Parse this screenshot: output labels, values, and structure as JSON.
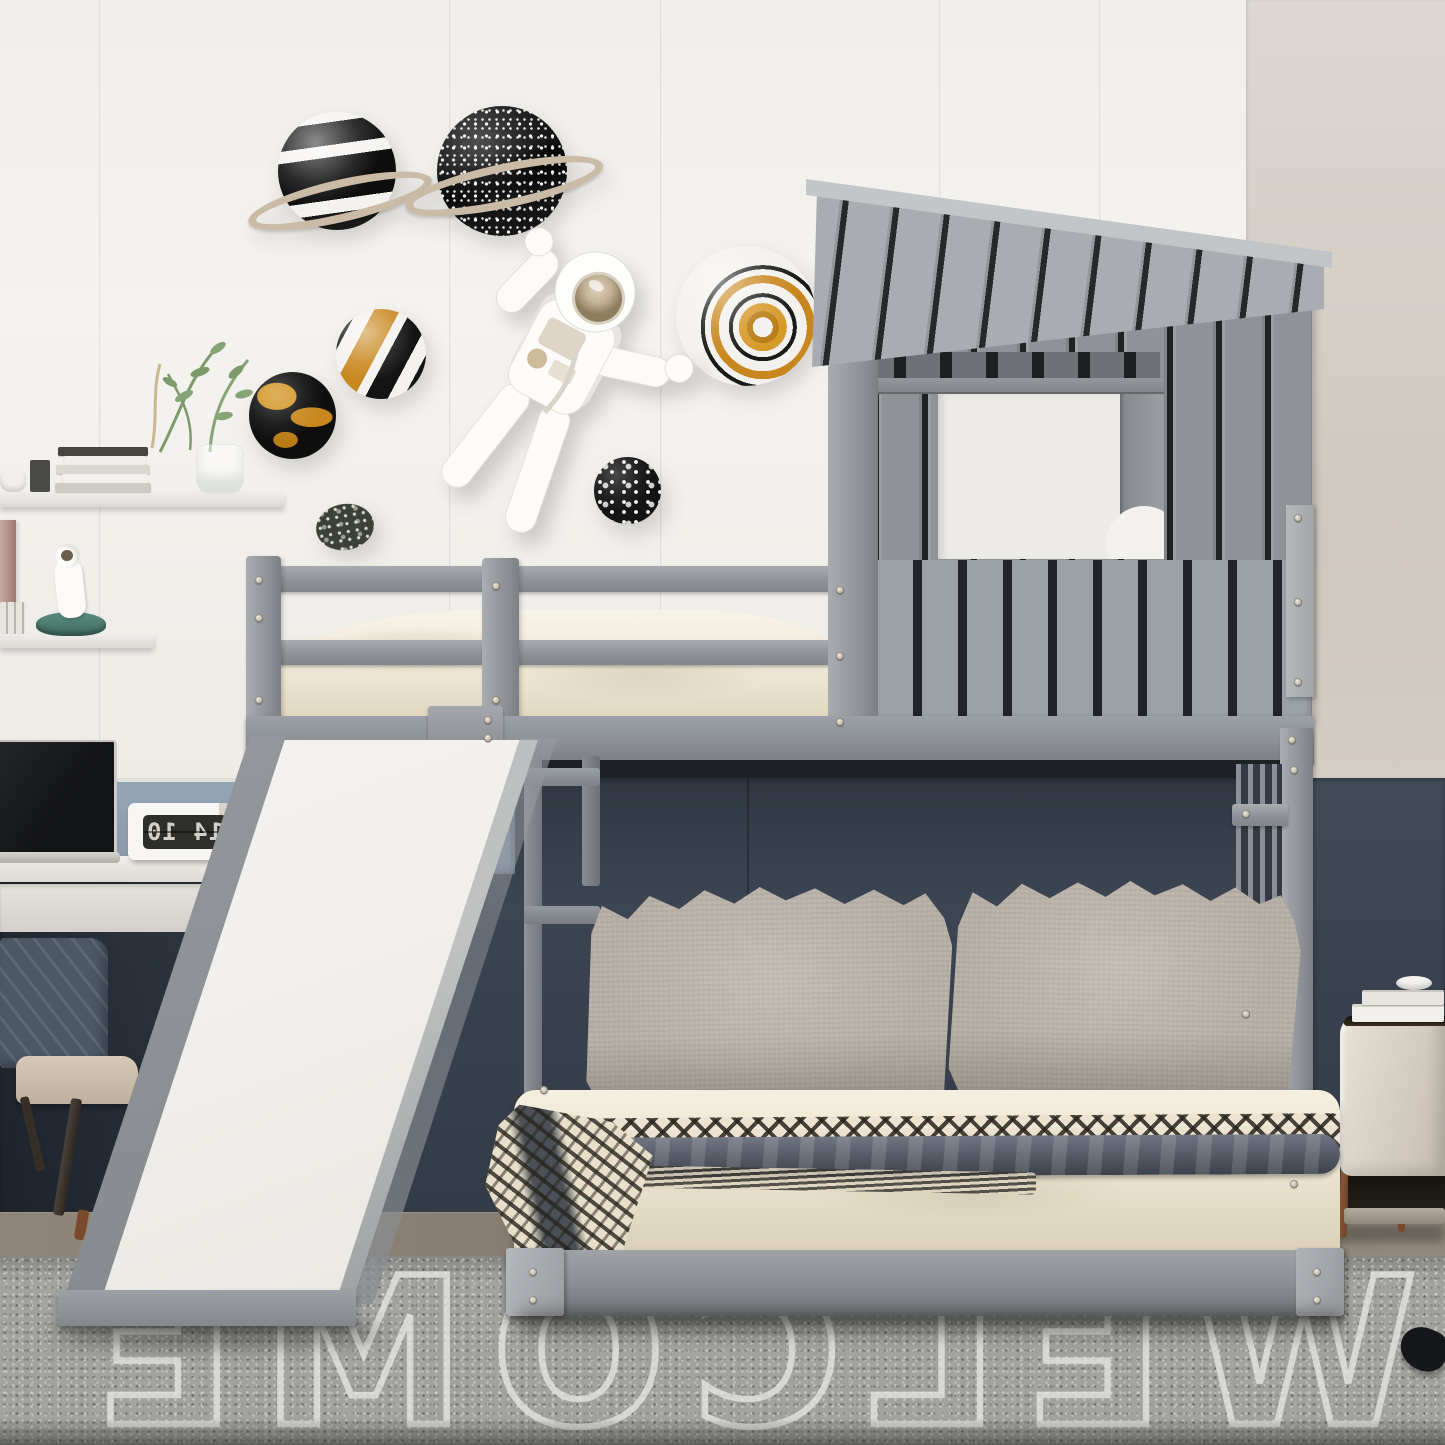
{
  "meta": {
    "title": "Kids bedroom with gray house-shaped loft bunk bed with slide over full-size platform bed",
    "style": "photorealistic interior render"
  },
  "colors": {
    "wallWhite": "#f2f0ed",
    "wallGreige": "#d6d0c9",
    "wainscot": "#3b4450",
    "wainscotDark": "#272e38",
    "panelBlue": "#8d9fb1",
    "wood": "#8b8177",
    "carpet": "#a2a29e",
    "carpetLine": "#e7e7e2",
    "carpetDarkBand": "#74736e",
    "bedGray": "#969a9e",
    "bedGrayLight": "#b2b5b8",
    "bedGrayDark": "#7c8084",
    "slatGap": "#24272a",
    "mattressCream": "#f2ecdc",
    "beddingCream": "#eae2cf",
    "pillowGray": "#b7b0a7",
    "throwGray": "#565c67",
    "blanketInk": "#2e2c27",
    "slideWhite": "#f6f4f1",
    "furnWhite": "#e9e6e2",
    "nightstand": "#d9d3c9",
    "nightstandTop": "#30261d",
    "copper": "#8a5637",
    "chairBack": "#4c5866",
    "chairSeat": "#c9bdaa",
    "legWood": "#3a332c",
    "screenDark": "#1a1b1d",
    "silver": "#c9c6c2",
    "clockBody": "#f6f4f0",
    "clockFace": "#2e2e2b",
    "clockDigits": "#d2d0c9",
    "gold": "#c8871e",
    "ringTan": "#c9bba6",
    "planetInk": "#141414",
    "planetWhite": "#f5f3f0",
    "suitWhite": "#fdfcfa",
    "visorGold": "#c2b194",
    "plantGreen": "#7d9a6b",
    "rocketTeal": "#4f7f74"
  },
  "clock": {
    "display": "14 10",
    "mirrored": true
  },
  "carpet": {
    "word": "WELCOME",
    "mirrored": true
  },
  "scene_items": {
    "wall_decor": [
      "striped planet with ring",
      "dotted planet with ring",
      "gold striped planet",
      "gold-black globe",
      "marbled swirl planet",
      "speckled moon",
      "speckled rock",
      "astronaut wall figurine"
    ],
    "left_side": [
      "floating shelf with books and plant",
      "lower shelf with astronaut rocket toy",
      "desk with drawer",
      "laptop",
      "mirrored flip clock",
      "desk chair"
    ],
    "bed": [
      "house-shaped loft with slatted roof and window",
      "top bunk with guard rails",
      "white slide",
      "ladder",
      "full-size platform bed",
      "two linen pillows",
      "zigzag blanket with dark throw"
    ],
    "right_side": [
      "cream nightstand with copper legs",
      "stacked books"
    ]
  }
}
